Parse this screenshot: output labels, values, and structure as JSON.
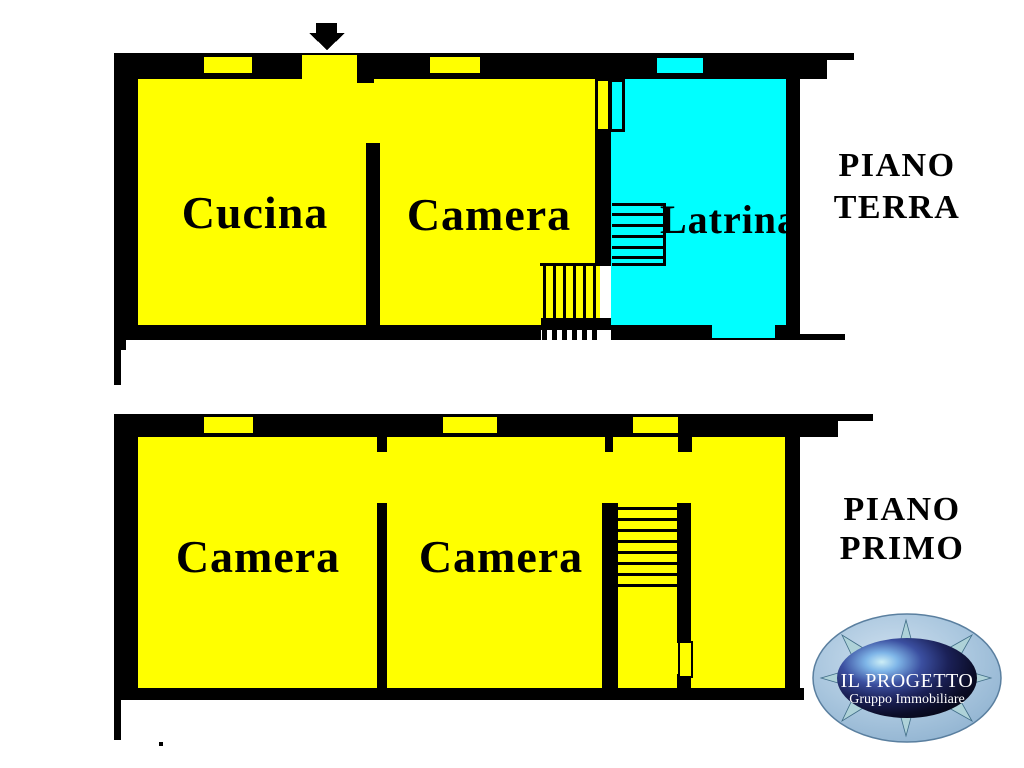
{
  "colors": {
    "background": "#ffffff",
    "wall": "#000000",
    "room_yellow": "#ffff00",
    "toilet_cyan": "#00ffff",
    "logo_ring_blue": "#a9c6de",
    "logo_core_navy": "#1b2158",
    "logo_ray_teal": "#aed2d8",
    "logo_text": "#ffffff"
  },
  "ground_floor": {
    "floor_label": [
      "PIANO",
      "TERRA"
    ],
    "rooms": [
      {
        "label": "Cucina"
      },
      {
        "label": "Camera"
      },
      {
        "label": "Latrina"
      }
    ]
  },
  "first_floor": {
    "floor_label": [
      "PIANO",
      "PRIMO"
    ],
    "rooms": [
      {
        "label": "Camera"
      },
      {
        "label": "Camera"
      }
    ]
  },
  "logo": {
    "company": "IL PROGETTO",
    "subtitle": "Gruppo Immobiliare"
  }
}
